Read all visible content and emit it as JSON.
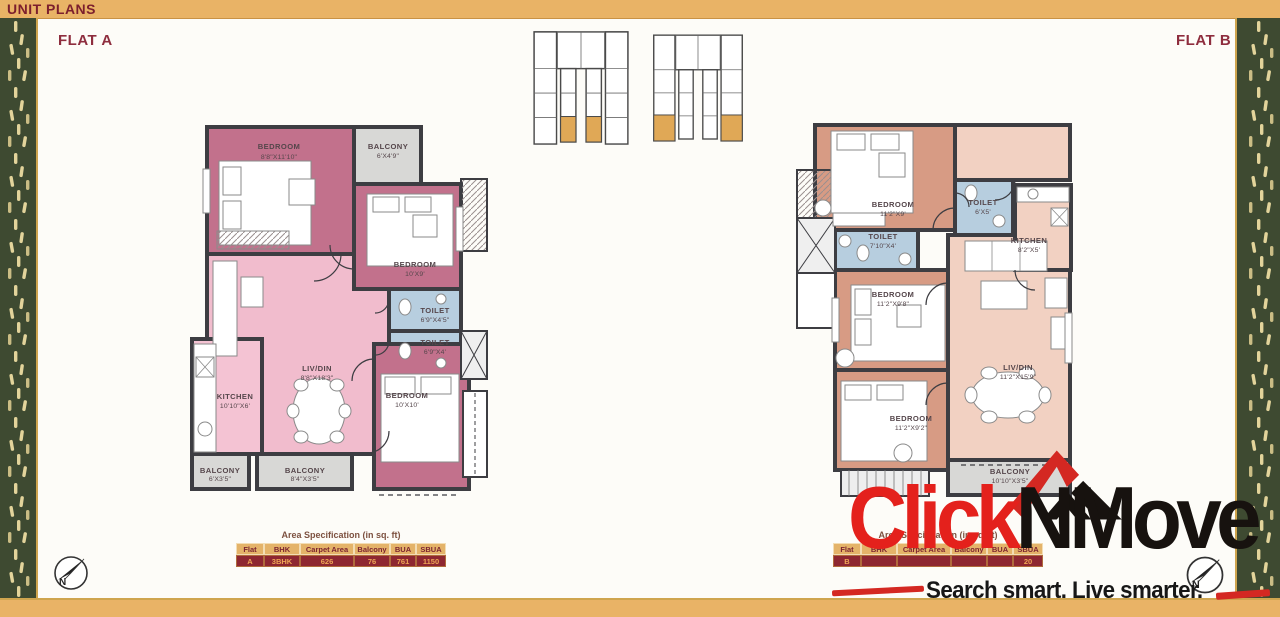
{
  "header": {
    "title": "UNIT PLANS"
  },
  "flat_a": {
    "label": "FLAT A",
    "rooms": {
      "bedroom1": {
        "name": "BEDROOM",
        "dims": "8'8\"X11'10\""
      },
      "balcony1": {
        "name": "BALCONY",
        "dims": "6'X4'9\""
      },
      "bedroom2": {
        "name": "BEDROOM",
        "dims": "10'X9'"
      },
      "toilet1": {
        "name": "TOILET",
        "dims": "6'9\"X4'5\""
      },
      "toilet2": {
        "name": "TOILET",
        "dims": "6'9\"X4'"
      },
      "livdin": {
        "name": "LIV/DIN",
        "dims": "8'8\"X18'3\""
      },
      "kitchen": {
        "name": "KITCHEN",
        "dims": "10'10\"X6'"
      },
      "bedroom3": {
        "name": "BEDROOM",
        "dims": "10'X10'"
      },
      "balcony2": {
        "name": "BALCONY",
        "dims": "6'X3'5\""
      },
      "balcony3": {
        "name": "BALCONY",
        "dims": "8'4\"X3'5\""
      }
    },
    "table": {
      "title": "Area Specification (in sq. ft)",
      "headers": [
        "Flat",
        "BHK",
        "Carpet Area",
        "Balcony",
        "BUA",
        "SBUA"
      ],
      "values": [
        "A",
        "3BHK",
        "626",
        "76",
        "761",
        "1150"
      ]
    }
  },
  "flat_b": {
    "label": "FLAT B",
    "rooms": {
      "bedroom1": {
        "name": "BEDROOM",
        "dims": "11'2\"X9'"
      },
      "toilet1": {
        "name": "TOILET",
        "dims": "6'X5'"
      },
      "kitchen": {
        "name": "KITCHEN",
        "dims": "8'2\"X5'"
      },
      "toilet2": {
        "name": "TOILET",
        "dims": "7'10\"X4'"
      },
      "bedroom2": {
        "name": "BEDROOM",
        "dims": "11'2\"X9'8\""
      },
      "bedroom3": {
        "name": "BEDROOM",
        "dims": "11'2\"X9'2\""
      },
      "livdin": {
        "name": "LIV/DIN",
        "dims": "11'2\"X15'9\""
      },
      "balcony": {
        "name": "BALCONY",
        "dims": "10'10\"X3'5\""
      }
    },
    "table": {
      "title": "Area Specification (in sq. ft)",
      "headers": [
        "Flat",
        "BHK",
        "Carpet Area",
        "Balcony",
        "BUA",
        "SBUA"
      ],
      "values": [
        "B",
        "",
        "",
        "",
        "",
        "20"
      ]
    }
  },
  "watermark": {
    "brand_red": "Click",
    "brand_dark": "NMove",
    "tagline": "Search smart. Live smarter."
  },
  "compass": {
    "label": "N"
  },
  "colors": {
    "bar_orange": "#e9b366",
    "maroon_text": "#8e2d3e",
    "strip_green": "#3e4a31",
    "strip_dash_gold": "#e3d49b",
    "flat_a_room_pink": "#c2718c",
    "flat_a_living_pink": "#f1bccd",
    "flat_b_room_salmon": "#d79b84",
    "flat_b_living_salmon": "#f2d1c2",
    "toilet_blue": "#b7cedf",
    "balcony_gray": "#d8d8d6",
    "wall_gray": "#3d3d42",
    "table_header_bg": "#e4b369",
    "table_row_bg": "#8e2731",
    "logo_red": "#e4211c",
    "logo_black": "#17120f"
  }
}
